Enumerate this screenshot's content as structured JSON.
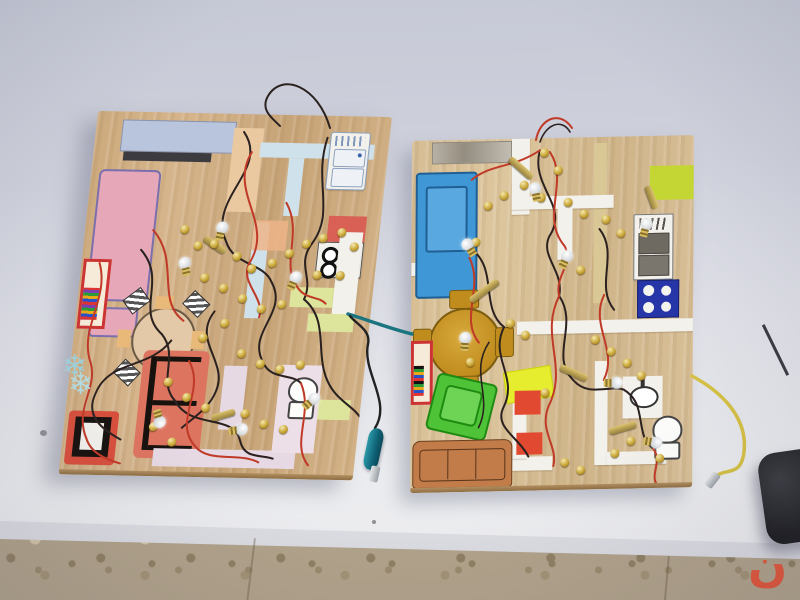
{
  "image_type": "photograph",
  "scene": {
    "setting": "Two handmade school-project electrical wiring boards (house floor plans on plywood) lying on a white table against a pale blue-grey wall, beige terrazzo tile floor in front",
    "wall_color": "#c9ccd8",
    "table_color": "#ededf0",
    "floor_color": "#b1a28a"
  },
  "watermark": {
    "glyph": "ن",
    "color": "#e25539"
  },
  "boards": {
    "left": {
      "wood_color": "#cdab7e",
      "items": [
        "pink-bed",
        "blue-headboard",
        "orange-wall",
        "light-blue-walls",
        "fridge-drawing",
        "red-counter",
        "stove-four-burners",
        "green-wall-strips",
        "bookshelf",
        "round-dining-table-with-striped-chairs",
        "red-sofa",
        "tv-set",
        "toilet-drawing",
        "lavender-walls",
        "snowflake-sticker"
      ],
      "fasteners": "brass paper brads",
      "bulbs": "small screw-base lamps",
      "wire_colors": [
        "#c03a28",
        "#2b2220"
      ],
      "lead": "black wire ending in teal alligator clip"
    },
    "right": {
      "wood_color": "#d6bd94",
      "items": [
        "grey-sketch",
        "blue-bed",
        "white-paper-walls",
        "yellow-green-patch",
        "grey-fridge",
        "blue-burner-panel",
        "gold-round-table-with-chairs",
        "bookshelf",
        "green-armchair",
        "yellow-rug",
        "red-cushions",
        "tan-sofa",
        "bathroom-sink",
        "toilet-drawing"
      ],
      "fasteners": "brass paper brads",
      "bulbs": "small screw-base lamps",
      "wire_colors": [
        "#c03a28",
        "#2b2220"
      ],
      "lead": "yellow wire ending in bare metal alligator clip"
    }
  },
  "other_objects": {
    "teal_clip": "teal alligator clip lying between the boards",
    "metal_clip": "silver alligator clip on yellow lead",
    "dark_object": "black rounded pouch at right edge of table",
    "tool": "thin screwdriver / probe at right edge",
    "debris": "small grey speck on table"
  },
  "palette": {
    "brass": "#c9a636",
    "teal": "#106377",
    "yellow_wire": "#d6c144",
    "crayon_red": "#dd6a55",
    "crayon_blue": "#3f97d6",
    "crayon_green": "#4fc338",
    "crayon_gold": "#c08c1e"
  }
}
